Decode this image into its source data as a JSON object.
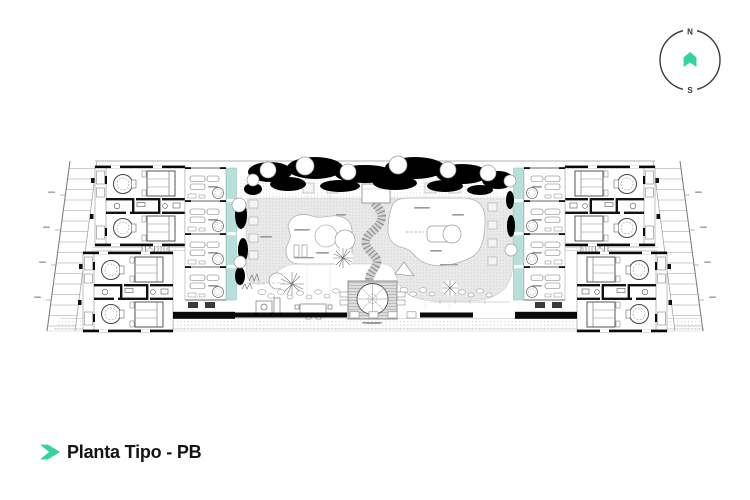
{
  "title": {
    "label": "Planta Tipo - PB"
  },
  "compass": {
    "north": "N",
    "south": "S"
  },
  "drawing": {
    "name": "typical-floor-plan-ground-level"
  },
  "colors": {
    "accent_green": "#34d399",
    "pool_teal": "#b7e0da",
    "canopy_black": "#000000",
    "deck_gray": "#e9e9e9",
    "line_dark": "#444444",
    "line_light": "#aaaaaa"
  },
  "icons": {
    "title_icon": "chevron-right-icon",
    "compass_icon": "north-marker-icon"
  }
}
